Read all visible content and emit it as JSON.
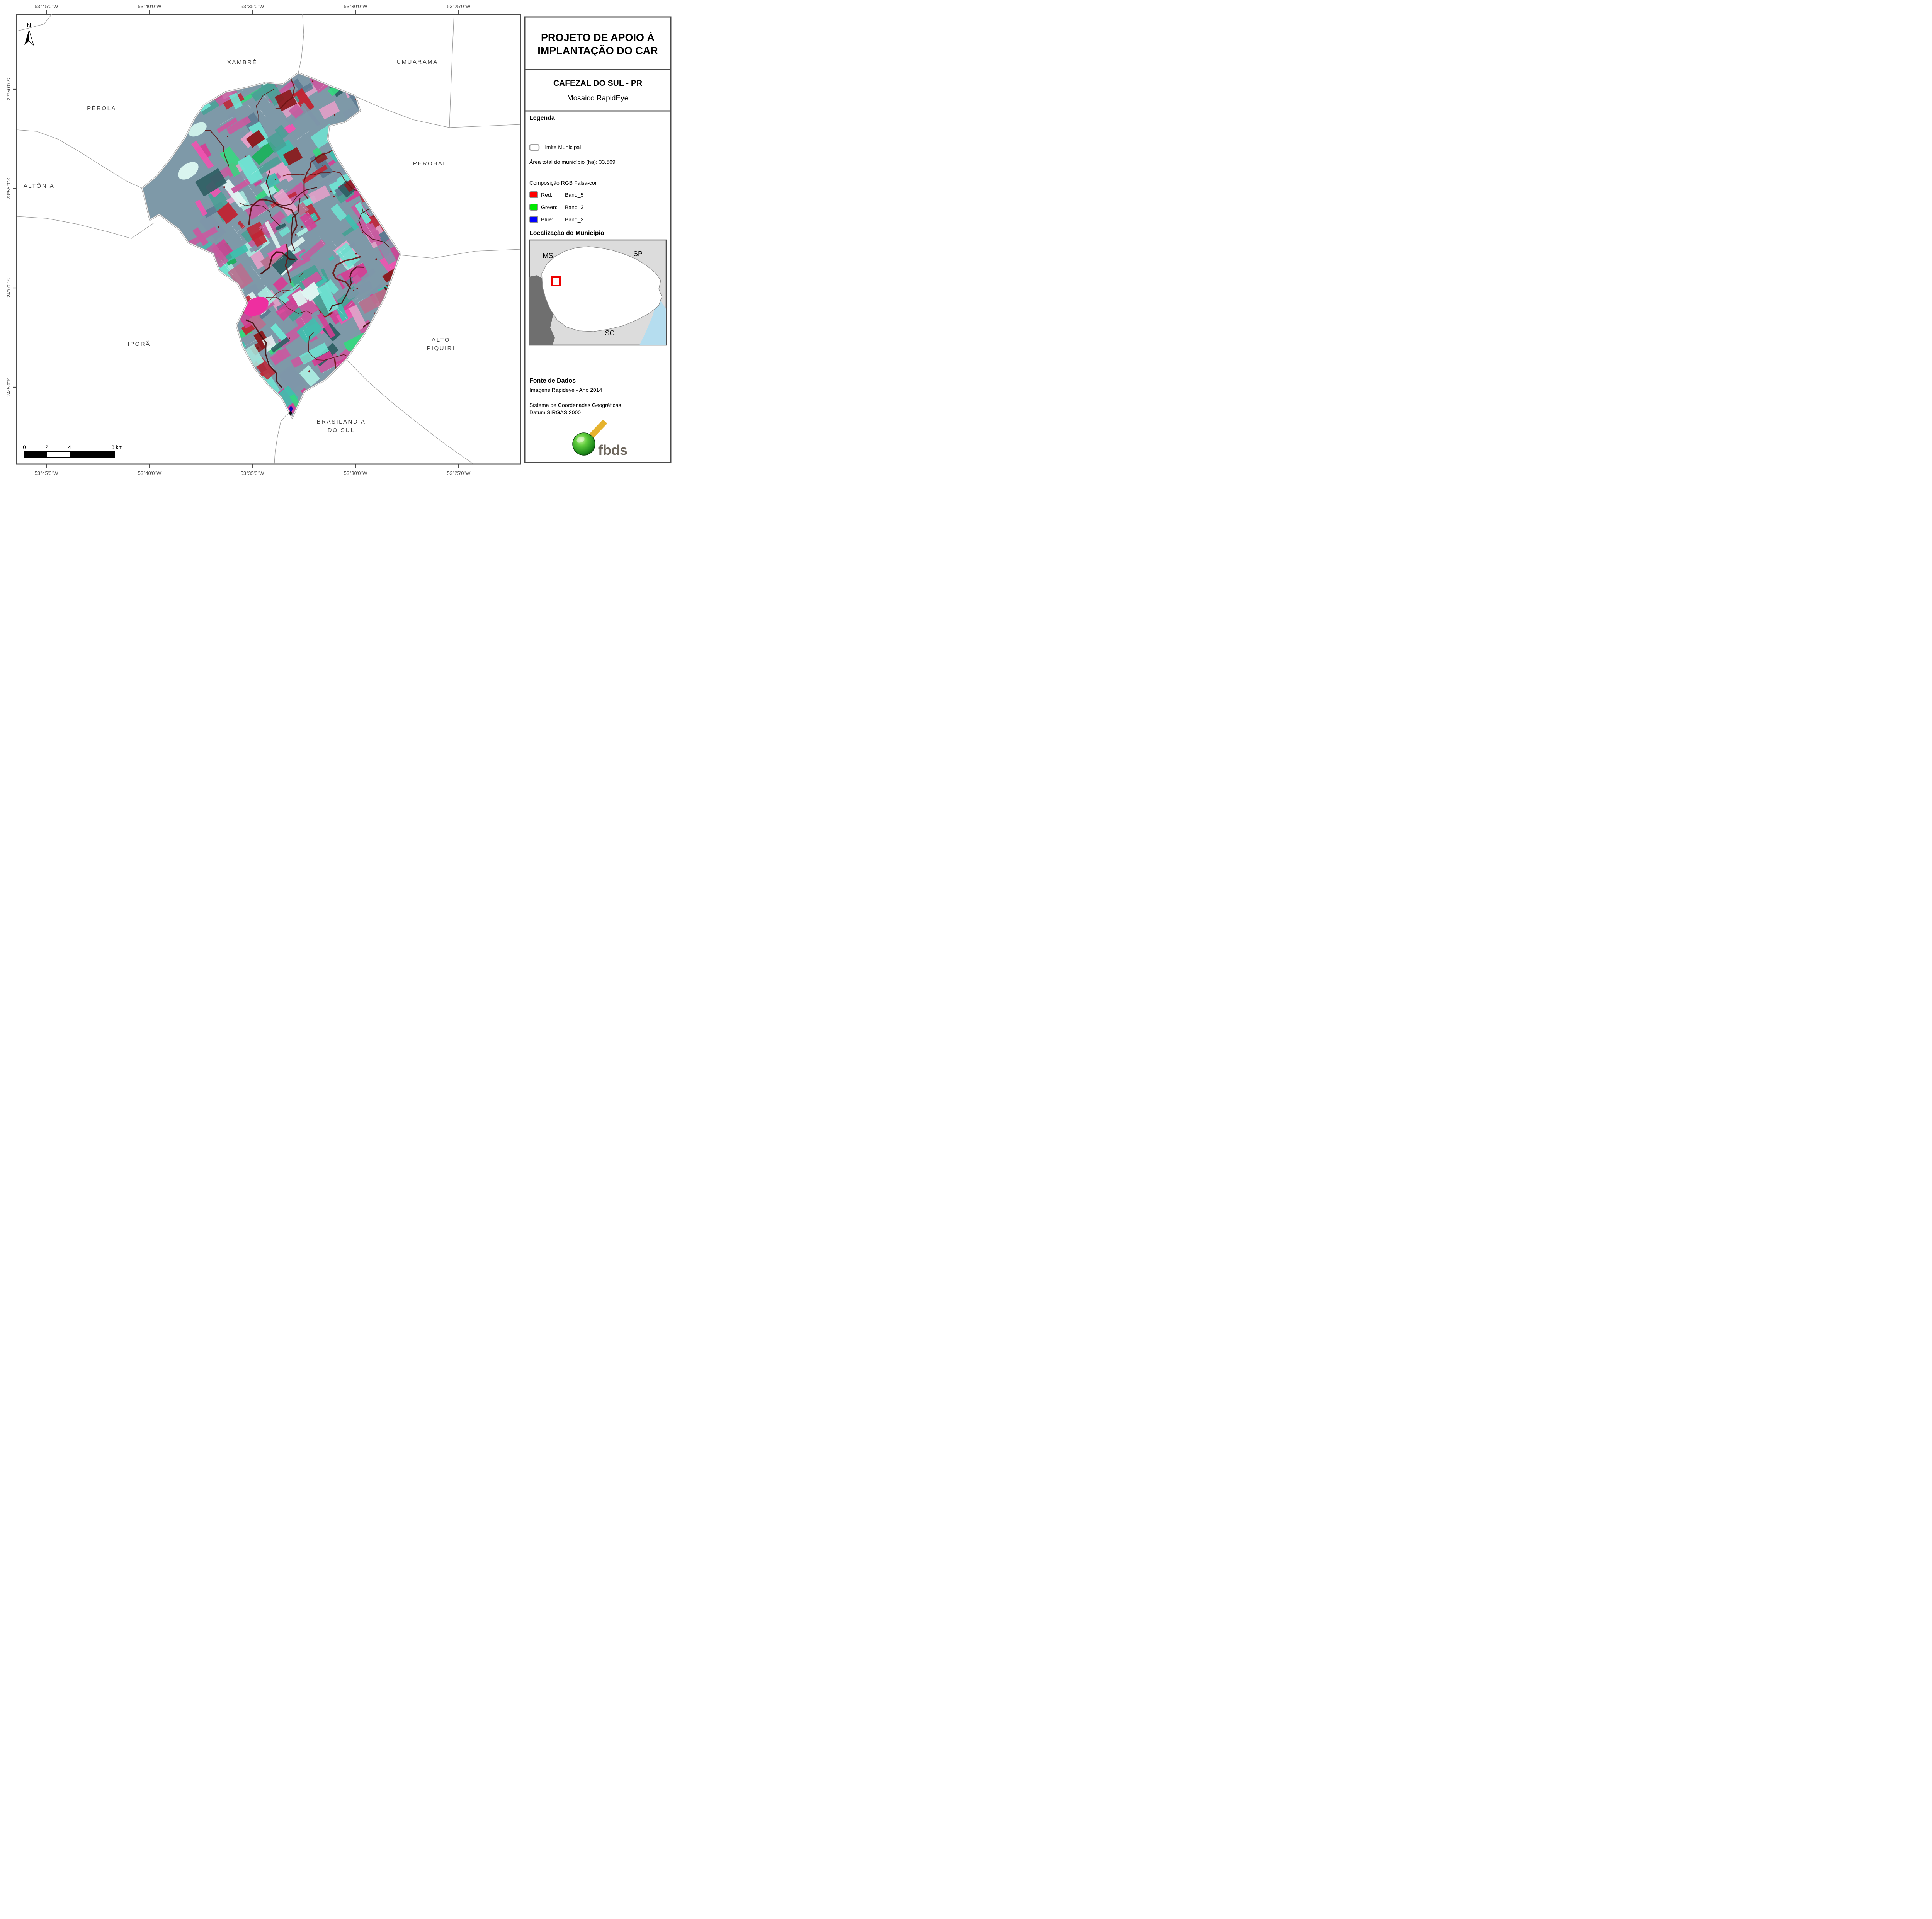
{
  "header": {
    "title_line1": "PROJETO DE APOIO À",
    "title_line2": "IMPLANTAÇÃO DO CAR",
    "municipality": "CAFEZAL DO SUL - PR",
    "product": "Mosaico RapidEye"
  },
  "legend": {
    "heading": "Legenda",
    "limite_label": "Limite Municipal",
    "area_label": "Área total do município (ha): 33.569",
    "rgb_heading": "Composição RGB Falsa-cor",
    "rgb_rows": [
      {
        "name": "Red:",
        "band": "Band_5",
        "color": "#ff0000"
      },
      {
        "name": "Green:",
        "band": "Band_3",
        "color": "#00e800"
      },
      {
        "name": "Blue:",
        "band": "Band_2",
        "color": "#0000ff"
      }
    ]
  },
  "location": {
    "heading": "Localização do Município",
    "labels": {
      "ms": "MS",
      "sp": "SP",
      "sc": "SC"
    },
    "highlight_color": "#ee0000"
  },
  "source": {
    "heading": "Fonte de Dados",
    "line1": "Imagens Rapideye - Ano 2014",
    "line2": "Sistema de Coordenadas Geográficas",
    "line3": "Datum SIRGAS 2000"
  },
  "logo": {
    "text": "fbds"
  },
  "map": {
    "north_label": "N",
    "neighbors": {
      "xambre": "XAMBRÊ",
      "umuarama": "UMUARAMA",
      "perola": "PÉROLA",
      "perobal": "PEROBAL",
      "altonia": "ALTÔNIA",
      "ipora": "IPORÃ",
      "alto_piquiri_1": "ALTO",
      "alto_piquiri_2": "PIQUIRI",
      "brasilandia_1": "BRASILÂNDIA",
      "brasilandia_2": "DO SUL"
    },
    "lon_labels": [
      "53°45'0\"W",
      "53°40'0\"W",
      "53°35'0\"W",
      "53°30'0\"W",
      "53°25'0\"W"
    ],
    "lat_labels": [
      "23°50'0\"S",
      "23°55'0\"S",
      "24°0'0\"S",
      "24°5'0\"S"
    ],
    "scalebar": {
      "t0": "0",
      "t2": "2",
      "t4": "4",
      "t8": "8 km"
    }
  }
}
